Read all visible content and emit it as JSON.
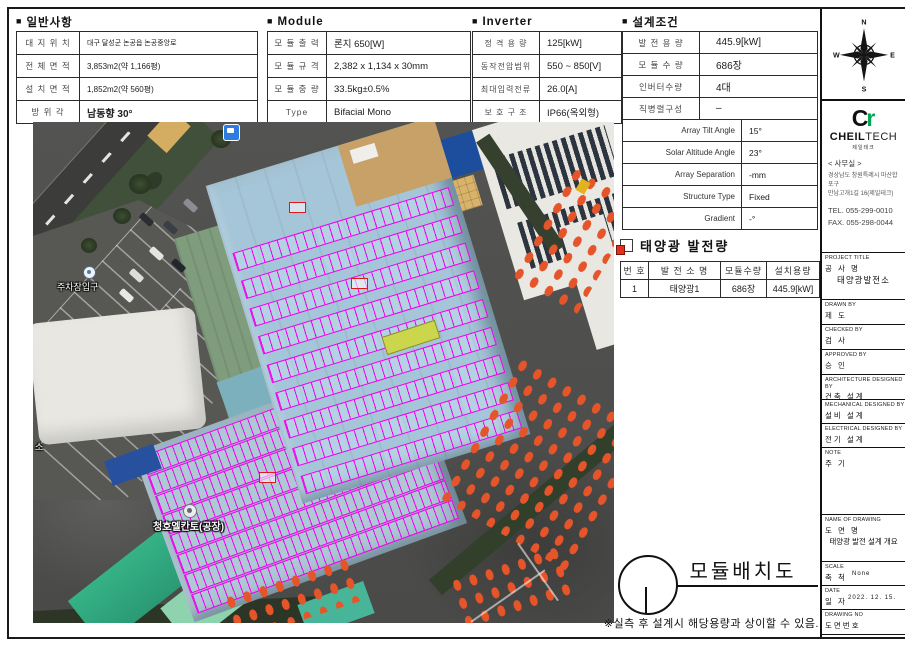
{
  "bullet": "■",
  "colors": {
    "panel_magenta": "#f000f0",
    "roof_blue": "#a5c6d8",
    "truck_orange": "#e65429",
    "logo_green": "#00a651",
    "doc_icon_red": "#e0301e"
  },
  "sections": {
    "general": {
      "title": "일반사항",
      "rows": [
        {
          "label": "대 지 위 치",
          "value": "대구 달성군 논공읍 논공중앙로"
        },
        {
          "label": "전 체 면 적",
          "value": "3,853m2(약 1,166평)"
        },
        {
          "label": "설 치 면 적",
          "value": "1,852m2(약 560평)"
        },
        {
          "label": "방  위  각",
          "value": "남동향 30°"
        }
      ]
    },
    "module": {
      "title": "Module",
      "rows": [
        {
          "label": "모 듈 출 력",
          "value": "론지 650[W]"
        },
        {
          "label": "모 듈 규 격",
          "value": "2,382 x 1,134 x 30mm"
        },
        {
          "label": "모 듈 중 량",
          "value": "33.5kg±0.5%"
        },
        {
          "label": "Type",
          "value": "Bifacial Mono"
        }
      ]
    },
    "inverter": {
      "title": "Inverter",
      "rows": [
        {
          "label": "정 격 용 량",
          "value": "125[kW]"
        },
        {
          "label": "동작전압범위",
          "value": "550 ~ 850[V]"
        },
        {
          "label": "최대입력전류",
          "value": "26.0[A]"
        },
        {
          "label": "보 호 구 조",
          "value": "IP66(옥외형)"
        }
      ]
    },
    "design": {
      "title": "설계조건",
      "rows_kr": [
        {
          "label": "발 전 용 량",
          "value": "445.9[kW]"
        },
        {
          "label": "모 듈 수 량",
          "value": "686장"
        },
        {
          "label": "인버터수량",
          "value": "4대"
        },
        {
          "label": "직병렬구성",
          "value": "–"
        }
      ],
      "rows_en": [
        {
          "label": "Array Tilt Angle",
          "value": "15°"
        },
        {
          "label": "Solar Altitude Angle",
          "value": "23°"
        },
        {
          "label": "Array Separation",
          "value": "-mm"
        },
        {
          "label": "Structure Type",
          "value": "Fixed"
        },
        {
          "label": "Gradient",
          "value": "-°"
        }
      ]
    }
  },
  "generation": {
    "title": "태양광 발전량",
    "headers": [
      "번 호",
      "발 전 소 명",
      "모듈수량",
      "설치용량"
    ],
    "rows": [
      [
        "1",
        "태양광1",
        "686장",
        "445.9[kW]"
      ]
    ]
  },
  "map": {
    "labels": {
      "parking": "주차장입구",
      "factory": "청호엘칸토(공장)",
      "edge": "소"
    }
  },
  "footer": {
    "drawing_title": "모듈배치도",
    "note": "※실측 후 설계시 해당용량과 상이할 수 있음."
  },
  "sidebar": {
    "compass": {
      "n": "N",
      "e": "E",
      "s": "S",
      "w": "W"
    },
    "logo": {
      "c": "C",
      "r": "r",
      "brand_bold": "CHEIL",
      "brand_light": "TECH",
      "sub": "제일테크"
    },
    "office": {
      "header": "< 사무실 >",
      "addr1": "경상남도 창원특례시 마산합포구",
      "addr2": "만남고개1길 16(제일테크)",
      "tel": "TEL. 055-299-0010",
      "fax": "FAX. 055-298-0044"
    },
    "titleblock": [
      {
        "en": "PROJECT TITLE",
        "kr": "공 사 명",
        "content": "태양광발전소"
      },
      {
        "en": "DRAWN BY",
        "kr": "제 도",
        "content": ""
      },
      {
        "en": "CHECKED BY",
        "kr": "검 사",
        "content": ""
      },
      {
        "en": "APPROVED BY",
        "kr": "승 인",
        "content": ""
      },
      {
        "en": "ARCHITECTURE DESIGNED BY",
        "kr": "건축 설계",
        "content": ""
      },
      {
        "en": "MECHANICAL DESIGNED BY",
        "kr": "설비 설계",
        "content": ""
      },
      {
        "en": "ELECTRICAL DESIGNED BY",
        "kr": "전기 설계",
        "content": ""
      },
      {
        "en": "NOTE",
        "kr": "주 기",
        "content": ""
      },
      {
        "en": "NAME OF DRAWING",
        "kr": "도 면 명",
        "content": "태양광 발전 설계 개요"
      },
      {
        "en": "SCALE",
        "kr": "축 척",
        "content": "None"
      },
      {
        "en": "DATE",
        "kr": "일 자",
        "content": "2022. 12. 15."
      },
      {
        "en": "DRAWING NO",
        "kr": "도면번호",
        "content": ""
      },
      {
        "en": "",
        "kr": "",
        "content": ""
      }
    ]
  }
}
